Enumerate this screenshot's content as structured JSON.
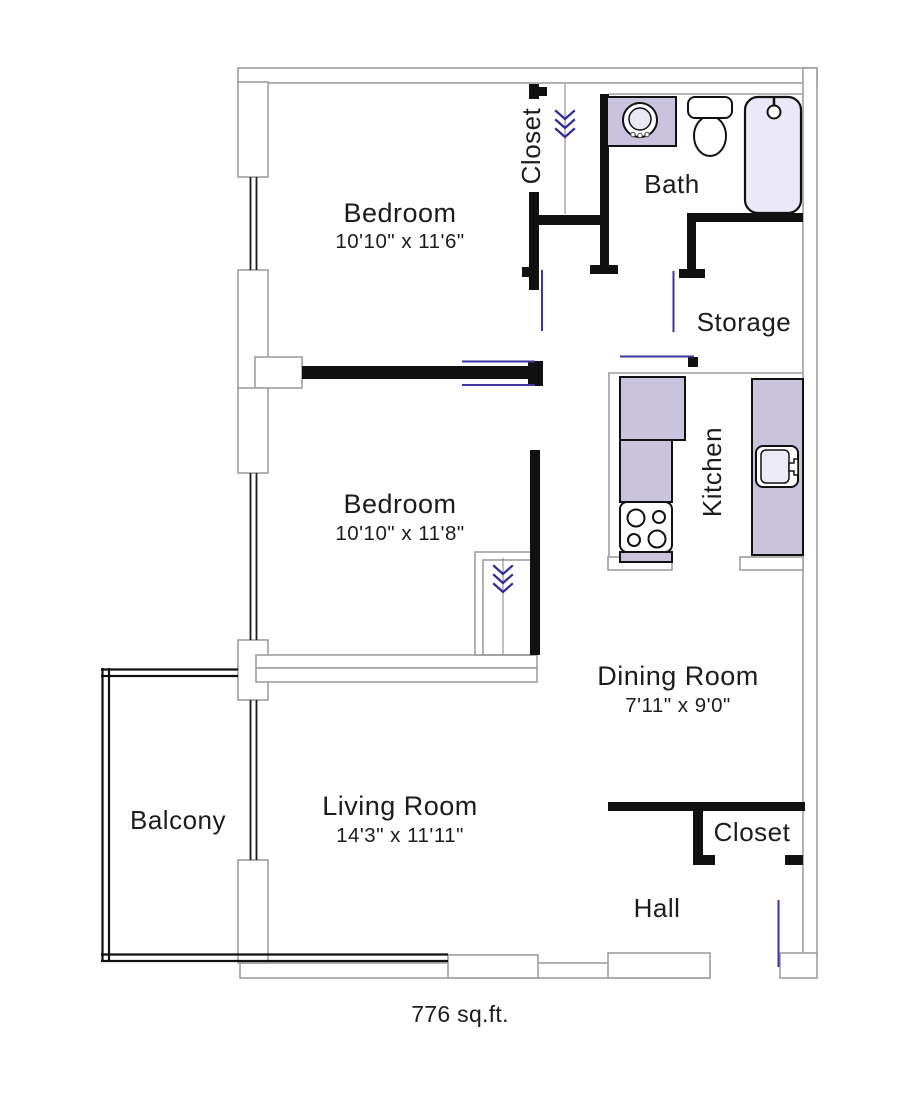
{
  "plan": {
    "area_label": "776 sq.ft.",
    "rooms": {
      "bedroom1": {
        "name": "Bedroom",
        "dims": "10'10\" x 11'6\""
      },
      "bedroom2": {
        "name": "Bedroom",
        "dims": "10'10\" x 11'8\""
      },
      "bath": {
        "name": "Bath"
      },
      "storage": {
        "name": "Storage"
      },
      "kitchen": {
        "name": "Kitchen"
      },
      "dining": {
        "name": "Dining Room",
        "dims": "7'11\" x 9'0\""
      },
      "living": {
        "name": "Living Room",
        "dims": "14'3\" x 11'11\""
      },
      "balcony": {
        "name": "Balcony"
      },
      "hall": {
        "name": "Hall"
      },
      "closet_bedroom1": {
        "name": "Closet"
      },
      "closet_hall": {
        "name": "Closet"
      }
    }
  },
  "colors": {
    "counter": "#c9c3de",
    "fixture": "#eae8f4",
    "door": "#3d35a1",
    "chevron": "#2f2a96",
    "wall": "#111111",
    "wall-outline": "#9e9e9e",
    "text": "#1c1c1c"
  }
}
